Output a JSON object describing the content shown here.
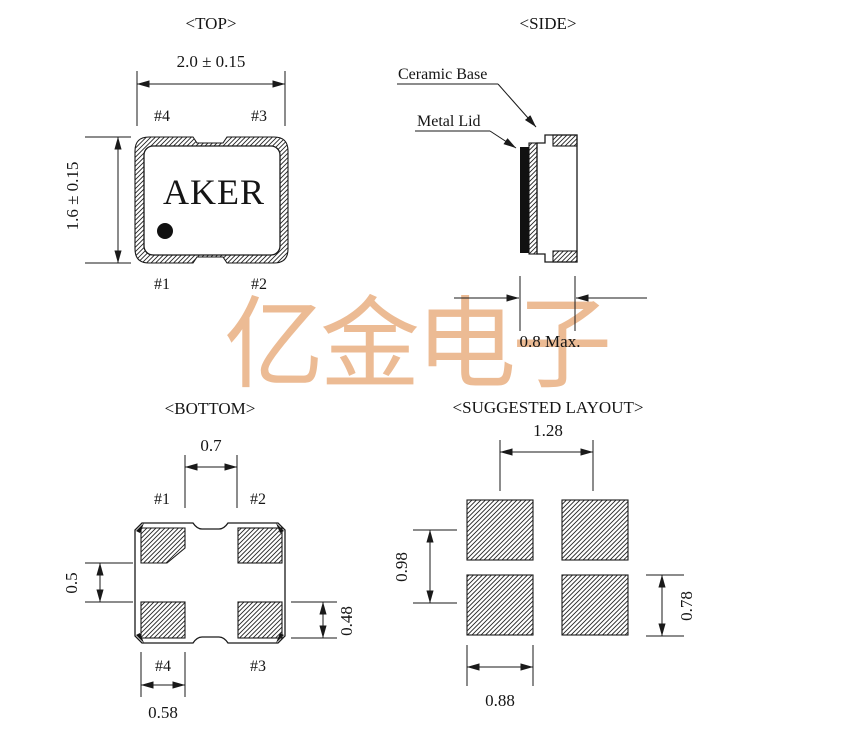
{
  "watermark": {
    "text": "亿金电子",
    "color": "#ECBB94"
  },
  "colors": {
    "line": "#1a1a1a",
    "background": "#ffffff"
  },
  "views": {
    "top": {
      "title": "<TOP>",
      "brand": "AKER",
      "dim_width": "2.0 ± 0.15",
      "dim_height": "1.6 ± 0.15",
      "pin_top_left": "#4",
      "pin_top_right": "#3",
      "pin_bottom_left": "#1",
      "pin_bottom_right": "#2"
    },
    "side": {
      "title": "<SIDE>",
      "label_ceramic_base": "Ceramic Base",
      "label_metal_lid": "Metal Lid",
      "dim_thickness": "0.8 Max."
    },
    "bottom": {
      "title": "<BOTTOM>",
      "pin_top_left": "#1",
      "pin_top_right": "#2",
      "pin_bottom_left": "#4",
      "pin_bottom_right": "#3",
      "dim_pad_gap_x": "0.7",
      "dim_pad_gap_y": "0.5",
      "dim_pad_height": "0.48",
      "dim_pad_width": "0.58"
    },
    "layout": {
      "title": "<SUGGESTED LAYOUT>",
      "dim_pitch_x": "1.28",
      "dim_pitch_y": "0.98",
      "dim_pad_height": "0.78",
      "dim_pad_width": "0.88"
    }
  }
}
